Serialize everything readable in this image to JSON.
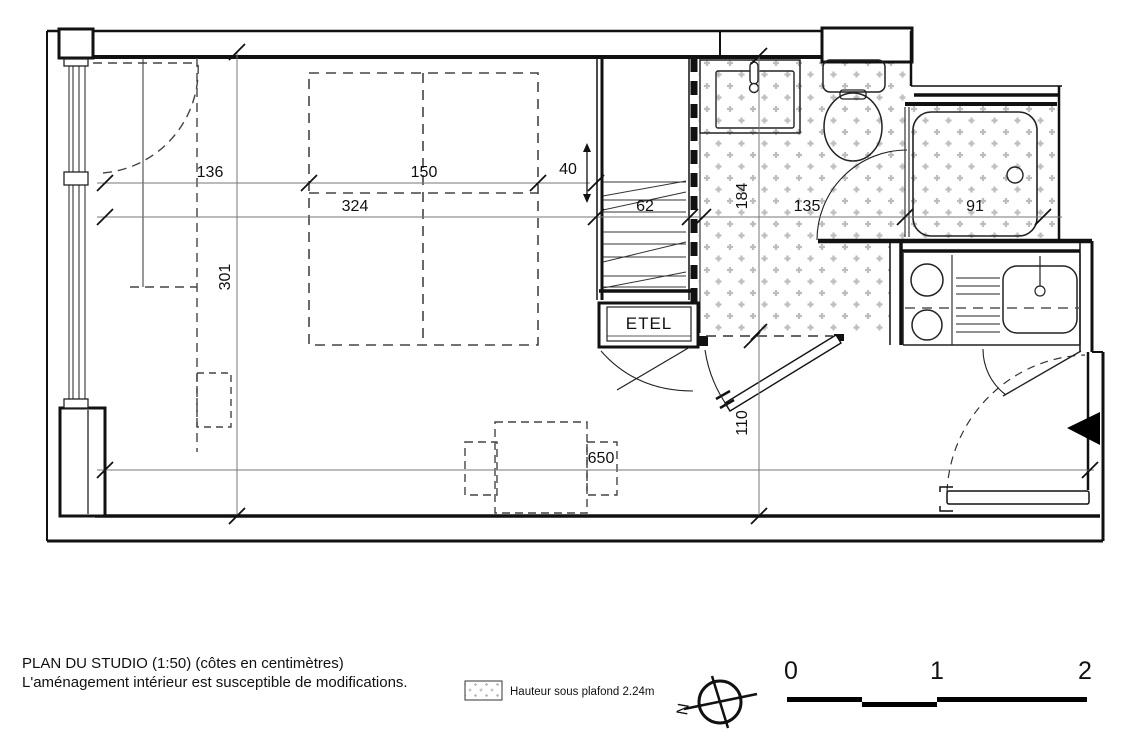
{
  "plan": {
    "dimensions": {
      "d136": "136",
      "d150": "150",
      "d40": "40",
      "d324": "324",
      "d62": "62",
      "d301": "301",
      "d184": "184",
      "d135": "135",
      "d91": "91",
      "d110": "110",
      "d650": "650"
    },
    "rooms": {
      "etel_label": "ETEL"
    }
  },
  "footer": {
    "title_line1": "PLAN DU STUDIO (1:50) (côtes en centimètres)",
    "title_line2": "L'aménagement intérieur est susceptible de modifications.",
    "legend_label": "Hauteur sous plafond 2.24m",
    "compass_north": "N",
    "scale": {
      "t0": "0",
      "t1": "1",
      "t2": "2"
    }
  },
  "colors": {
    "wall": "#111111",
    "hatch": "#bdbdbd",
    "dim": "#777777",
    "dash": "#444444"
  }
}
